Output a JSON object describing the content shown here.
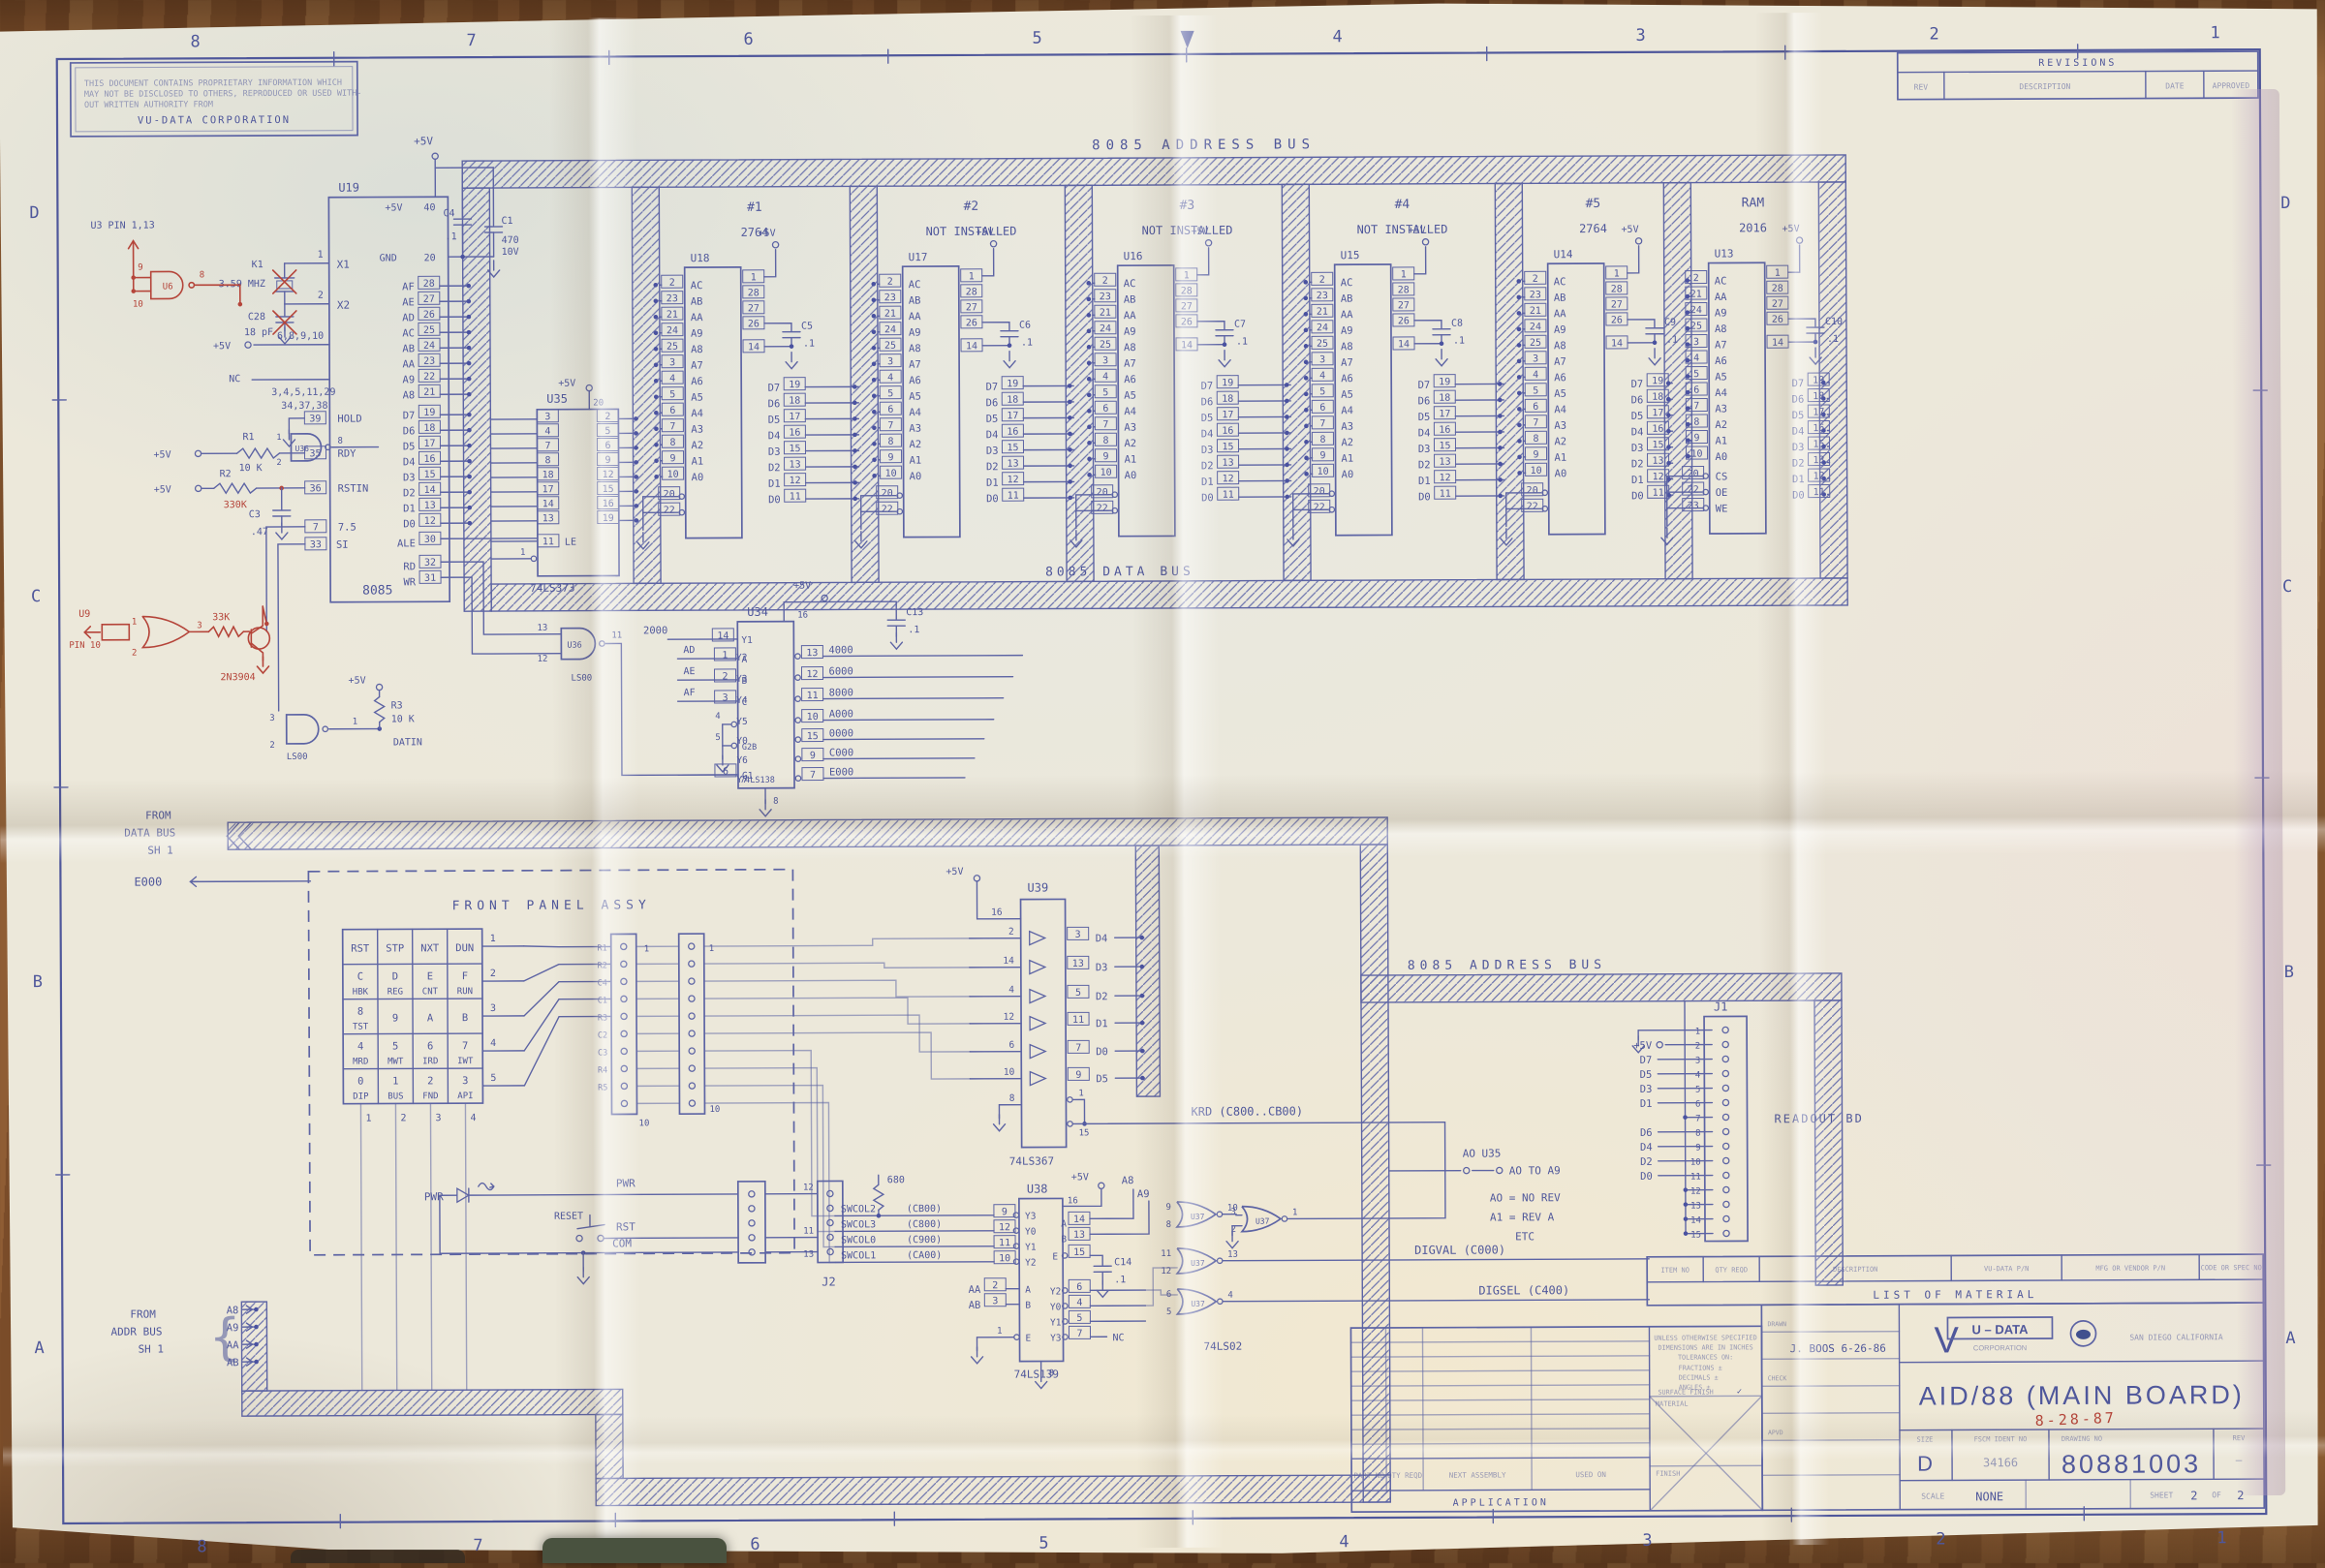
{
  "colors": {
    "ink": "#5d64a4",
    "red": "#b5453a",
    "paper": "#ece8da",
    "wood": "#8a5a35"
  },
  "sheet": {
    "zone_numbers": [
      "8",
      "7",
      "6",
      "5",
      "4",
      "3",
      "2",
      "1"
    ],
    "zone_letters": [
      "D",
      "C",
      "B",
      "A"
    ],
    "notice": [
      "THIS DOCUMENT CONTAINS PROPRIETARY INFORMATION WHICH",
      "MAY NOT BE DISCLOSED TO OTHERS, REPRODUCED OR USED WITH-",
      "OUT WRITTEN AUTHORITY FROM",
      "VU-DATA CORPORATION"
    ],
    "revisions": {
      "title": "REVISIONS",
      "rev": "REV",
      "description": "DESCRIPTION",
      "date": "DATE",
      "approved": "APPROVED"
    }
  },
  "buses": {
    "address_top": "8085 ADDRESS BUS",
    "data": "8085 DATA BUS",
    "address_lower": "8085 ADDRESS BUS",
    "from_data": [
      "FROM",
      "DATA BUS",
      "SH 1"
    ],
    "from_addr": [
      "FROM",
      "ADDR BUS",
      "SH 1"
    ],
    "from_addr_signals": [
      "A8",
      "A9",
      "AA",
      "AB"
    ],
    "e000": "E000"
  },
  "cpu": {
    "ref": "U19",
    "part": "8085",
    "u3_note": "U3  PIN 1,13",
    "x1": "X1",
    "x2": "X2",
    "p1": "1",
    "p2": "2",
    "k1": "K1",
    "freq": "3.59 MHZ",
    "c28": "C28",
    "c28v": "18 pF",
    "plus5": "+5V",
    "p40": "40",
    "c4": "C4",
    "c4v": ".1",
    "c1": "C1",
    "c1v": "470",
    "c1vv": "10V",
    "gnd": "GND",
    "p20": "20",
    "nc_plus5_pins": "6,8,9,10",
    "nc": "NC",
    "nc_pins1": "3,4,5,11,29",
    "nc_pins2": "34,37,38",
    "addr": [
      [
        "AF",
        "28"
      ],
      [
        "AE",
        "27"
      ],
      [
        "AD",
        "26"
      ],
      [
        "AC",
        "25"
      ],
      [
        "AB",
        "24"
      ],
      [
        "AA",
        "23"
      ],
      [
        "A9",
        "22"
      ],
      [
        "A8",
        "21"
      ]
    ],
    "hold": [
      "HOLD",
      "39"
    ],
    "rdy": [
      "RDY",
      "35"
    ],
    "rstin": [
      "RSTIN",
      "36"
    ],
    "r1": "R1",
    "r1v": "10 K",
    "r2": "R2",
    "c3": "C3",
    "c3v": ".47",
    "p7": "7",
    "p7f": "7.5",
    "p33": "33",
    "si": "SI",
    "data": [
      [
        "D7",
        "19"
      ],
      [
        "D6",
        "18"
      ],
      [
        "D5",
        "17"
      ],
      [
        "D4",
        "16"
      ],
      [
        "D3",
        "15"
      ],
      [
        "D2",
        "14"
      ],
      [
        "D1",
        "13"
      ],
      [
        "D0",
        "12"
      ]
    ],
    "ale": [
      "ALE",
      "30"
    ],
    "rd": [
      "RD",
      "32"
    ],
    "wr": [
      "WR",
      "31"
    ]
  },
  "latch": {
    "ref": "U35",
    "part": "74LS373",
    "inp": [
      "3",
      "4",
      "7",
      "8",
      "18",
      "17",
      "14",
      "13"
    ],
    "outp": [
      "2",
      "5",
      "6",
      "9",
      "12",
      "15",
      "16",
      "19"
    ],
    "le": "LE",
    "le_pin": "11",
    "oc_pin": "1",
    "p20": "20",
    "plus5": "+5V"
  },
  "u36": {
    "ref": "U36",
    "part": "LS00",
    "a_in": [
      "13",
      "12"
    ],
    "a_out": "11",
    "b_in": [
      "1",
      "2"
    ],
    "b_out": "8",
    "c_in": [
      "3",
      "2"
    ],
    "c_out": "1",
    "r3": "R3",
    "r3v": "10 K",
    "datin": "DATIN",
    "plus5": "+5V"
  },
  "decoder": {
    "ref": "U34",
    "part": "74LS138",
    "a": [
      "A",
      "1"
    ],
    "b": [
      "B",
      "2"
    ],
    "c": [
      "C",
      "3"
    ],
    "p4": "4",
    "g2b": [
      "G2B",
      "5"
    ],
    "g1": [
      "G1",
      "6"
    ],
    "p8": "8",
    "p16": "16",
    "plus5": "+5V",
    "cap": "C13",
    "capv": ".1",
    "y1": [
      "Y1",
      "14",
      "2000"
    ],
    "outs": [
      [
        "Y2",
        "13",
        "4000"
      ],
      [
        "Y3",
        "12",
        "6000"
      ],
      [
        "Y4",
        "11",
        "8000"
      ],
      [
        "Y5",
        "10",
        "A000"
      ],
      [
        "Y0",
        "15",
        "0000"
      ],
      [
        "Y6",
        "9",
        "C000"
      ],
      [
        "Y7",
        "7",
        "E000"
      ]
    ],
    "addr_in": [
      "AD",
      "AE",
      "AF"
    ]
  },
  "memory": {
    "plus5": "+5V",
    "chips": [
      {
        "ref": "U18",
        "tag": "#1",
        "part": "2764",
        "cap": "C5"
      },
      {
        "ref": "U17",
        "tag": "#2",
        "part": "NOT INSTALLED",
        "cap": "C6"
      },
      {
        "ref": "U16",
        "tag": "#3",
        "part": "NOT INSTALLED",
        "cap": "C7"
      },
      {
        "ref": "U15",
        "tag": "#4",
        "part": "NOT INSTALLED",
        "cap": "C8"
      },
      {
        "ref": "U14",
        "tag": "#5",
        "part": "2764",
        "cap": "C9"
      },
      {
        "ref": "U13",
        "tag": "RAM",
        "part": "2016",
        "cap": "C10"
      }
    ],
    "addr_rom": [
      [
        "2",
        "AC"
      ],
      [
        "23",
        "AB"
      ],
      [
        "21",
        "AA"
      ],
      [
        "24",
        "A9"
      ],
      [
        "25",
        "A8"
      ],
      [
        "3",
        "A7"
      ],
      [
        "4",
        "A6"
      ],
      [
        "5",
        "A5"
      ],
      [
        "6",
        "A4"
      ],
      [
        "7",
        "A3"
      ],
      [
        "8",
        "A2"
      ],
      [
        "9",
        "A1"
      ],
      [
        "10",
        "A0"
      ]
    ],
    "addr_ram": [
      [
        "2",
        "AC"
      ],
      [
        "21",
        "AA"
      ],
      [
        "24",
        "A9"
      ],
      [
        "25",
        "A8"
      ],
      [
        "3",
        "A7"
      ],
      [
        "4",
        "A6"
      ],
      [
        "5",
        "A5"
      ],
      [
        "6",
        "A4"
      ],
      [
        "7",
        "A3"
      ],
      [
        "8",
        "A2"
      ],
      [
        "9",
        "A1"
      ],
      [
        "10",
        "A0"
      ]
    ],
    "sel_rom": [
      [
        "20",
        ""
      ],
      [
        "22",
        ""
      ]
    ],
    "sel_ram": [
      [
        "20",
        "CS"
      ],
      [
        "22",
        "OE"
      ],
      [
        "23",
        "WE"
      ]
    ],
    "top_pins": [
      "1",
      "28",
      "27",
      "26",
      "14"
    ],
    "capv": ".1",
    "data_pins": [
      [
        "19",
        "D7"
      ],
      [
        "18",
        "D6"
      ],
      [
        "17",
        "D5"
      ],
      [
        "16",
        "D4"
      ],
      [
        "15",
        "D3"
      ],
      [
        "13",
        "D2"
      ],
      [
        "12",
        "D1"
      ],
      [
        "11",
        "D0"
      ]
    ]
  },
  "u39": {
    "ref": "U39",
    "part": "74LS367",
    "p16": "16",
    "p8": "8",
    "plus5": "+5V",
    "rows": [
      [
        "2",
        "3",
        "D4"
      ],
      [
        "14",
        "13",
        "D3"
      ],
      [
        "4",
        "5",
        "D2"
      ],
      [
        "12",
        "11",
        "D1"
      ],
      [
        "6",
        "7",
        "D0"
      ],
      [
        "10",
        "9",
        "D5"
      ]
    ],
    "en1": "1",
    "en15": "15",
    "krd": "KRD (C800..CB00)"
  },
  "u38": {
    "ref": "U38",
    "part": "74LS139",
    "swcol": [
      [
        "SWCOL2",
        "(CB00)",
        "9",
        "Y3"
      ],
      [
        "SWCOL3",
        "(C800)",
        "12",
        "Y0"
      ],
      [
        "SWCOL0",
        "(C900)",
        "11",
        "Y1"
      ],
      [
        "SWCOL1",
        "(CA00)",
        "10",
        "Y2"
      ]
    ],
    "aa": [
      "AA",
      "2",
      "A"
    ],
    "ab": [
      "AB",
      "3",
      "B"
    ],
    "e1": "1",
    "e1l": "E",
    "p16": "16",
    "plus5": "+5V",
    "a": [
      "A",
      "14"
    ],
    "b": [
      "B",
      "13"
    ],
    "e": [
      "E",
      "15"
    ],
    "cap": "C14",
    "capv": ".1",
    "youts": [
      [
        "Y2",
        "6"
      ],
      [
        "Y0",
        "4"
      ],
      [
        "Y1",
        "5"
      ],
      [
        "Y3",
        "7"
      ]
    ],
    "nc": "NC",
    "p8": "8",
    "r680": "680"
  },
  "u37": {
    "ref": "U37",
    "part": "74LS02",
    "gates": [
      [
        "9",
        "8",
        "10"
      ],
      [
        "3",
        "2",
        "1"
      ],
      [
        "11",
        "12",
        "13"
      ],
      [
        "6",
        "5",
        "4"
      ]
    ]
  },
  "notes": {
    "a0_u35": "AO U35",
    "a0_to": "AO TO A9",
    "rev0": "AO = NO REV",
    "rev1": "A1 = REV A",
    "etc": "ETC",
    "digval": "DIGVAL (C000)",
    "digsel": "DIGSEL (C400)",
    "a8": "A8",
    "a9": "A9",
    "readout": "READOUT BD"
  },
  "front_panel": {
    "title": "FRONT PANEL ASSY",
    "keys": [
      [
        [
          "RST"
        ],
        [
          "STP"
        ],
        [
          "NXT"
        ],
        [
          "DUN"
        ]
      ],
      [
        [
          "C",
          "HBK"
        ],
        [
          "D",
          "REG"
        ],
        [
          "E",
          "CNT"
        ],
        [
          "F",
          "RUN"
        ]
      ],
      [
        [
          "8",
          "TST"
        ],
        [
          "9"
        ],
        [
          "A"
        ],
        [
          "B"
        ]
      ],
      [
        [
          "4",
          "MRD"
        ],
        [
          "5",
          "MWT"
        ],
        [
          "6",
          "IRD"
        ],
        [
          "7",
          "IWT"
        ]
      ],
      [
        [
          "0",
          "DIP"
        ],
        [
          "1",
          "BUS"
        ],
        [
          "2",
          "FND"
        ],
        [
          "3",
          "API"
        ]
      ]
    ],
    "row_nums": [
      "1",
      "2",
      "3",
      "4",
      "5"
    ],
    "col_nums": [
      "1",
      "2",
      "3",
      "4"
    ],
    "conn_labels": [
      "R1",
      "R2",
      "C4",
      "C1",
      "R3",
      "C2",
      "C3",
      "R4",
      "R5"
    ],
    "pin_first": "1",
    "pin_last": "10",
    "pwr_led": "PWR",
    "reset": "RESET",
    "sig_pwr": "PWR",
    "sig_rst": "RST",
    "sig_com": "COM",
    "j2": "J2",
    "j2_pins": [
      "12",
      "11",
      "13"
    ]
  },
  "j1": {
    "ref": "J1",
    "signals": {
      "2": "+5V",
      "3": "D7",
      "4": "D5",
      "5": "D3",
      "6": "D1",
      "8": "D6",
      "9": "D4",
      "10": "D2",
      "11": "D0"
    }
  },
  "red": {
    "date": "8-28-87",
    "u9": "U9",
    "u9_pin": "PIN 10",
    "g_in": [
      "1",
      "2"
    ],
    "g_out": "3",
    "r": "33K",
    "q": "2N3904",
    "u6": "U6",
    "u6_in": [
      "9",
      "10"
    ],
    "u6_out": "8",
    "r2v": "330K"
  },
  "title_block": {
    "lom": "LIST OF MATERIAL",
    "item_no": "ITEM NO",
    "qty": "QTY REQD",
    "descr": "DESCRIPTION",
    "vudata_pn": "VU-DATA P/N",
    "vendor_pn": "MFG OR VENDOR P/N",
    "code_spec": "CODE OR SPEC NO",
    "drawn_label": "DRAWN",
    "checked_label": "CHECK",
    "apvd_label": "APVD",
    "drawn": "J. BOOS  6-26-86",
    "v": "V",
    "company_top": "U – DATA",
    "company_bottom": "CORPORATION",
    "city": "SAN DIEGO  CALIFORNIA",
    "title": "AID/88 (MAIN BOARD)",
    "size_label": "SIZE",
    "size": "D",
    "fscm_label": "FSCM IDENT NO",
    "fscm": "34166",
    "dwg_label": "DRAWING NO",
    "dwg": "80881003",
    "rev_label": "REV",
    "rev": "—",
    "scale_label": "SCALE",
    "scale": "NONE",
    "sheet_label": "SHEET",
    "sheet": "2",
    "of": "OF",
    "sheet_total": "2"
  },
  "application": {
    "part_no": "PART NO",
    "qty": "QTY REQD",
    "next_assy": "NEXT ASSEMBLY",
    "used_on": "USED ON",
    "title": "APPLICATION",
    "notes": [
      "UNLESS OTHERWISE SPECIFIED",
      "DIMENSIONS ARE IN INCHES",
      "TOLERANCES ON:",
      "FRACTIONS ±",
      "DECIMALS ±",
      "ANGLES ±",
      "SURFACE FINISH"
    ],
    "check": "✓",
    "material": "MATERIAL",
    "finish": "FINISH"
  }
}
